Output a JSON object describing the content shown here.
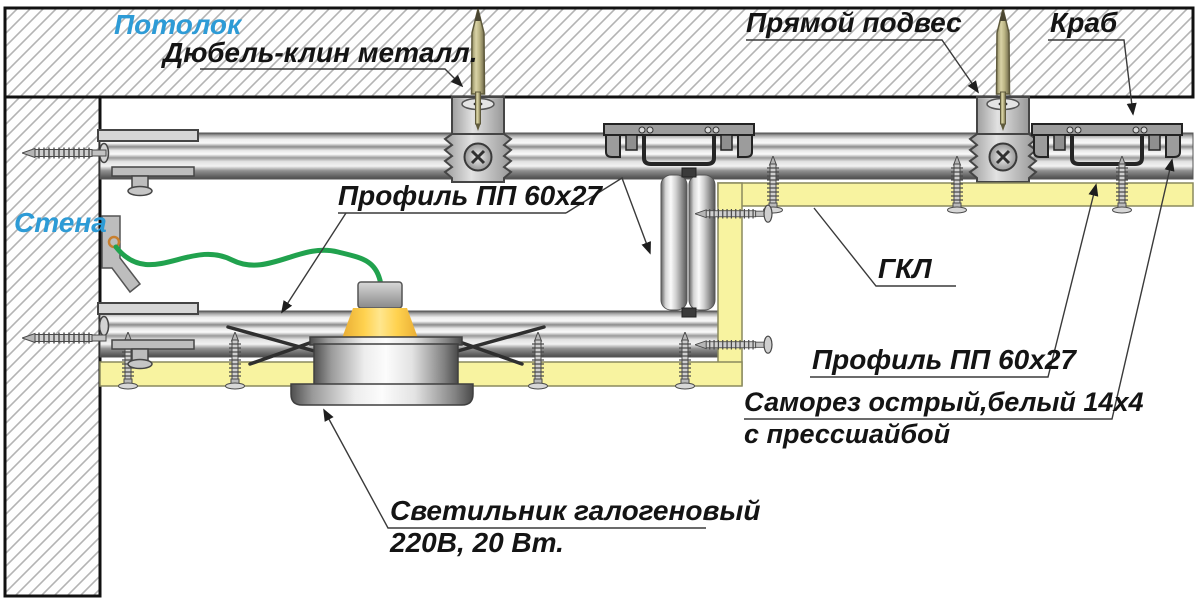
{
  "labels": {
    "ceiling": "Потолок",
    "anchor": "Дюбель-клин металл.",
    "direct_hanger": "Прямой подвес",
    "crab": "Краб",
    "wall": "Стена",
    "profile_mid": "Профиль ПП 60х27",
    "gkl": "ГКЛ",
    "profile_right": "Профиль ПП 60х27",
    "screw_line1": "Саморез острый,белый 14х4",
    "screw_line2": "с прессшайбой",
    "lamp_line1": "Светильник галогеновый",
    "lamp_line2": "220В, 20 Вт."
  },
  "colors": {
    "label_blue": "#2d9bd6",
    "label_black": "#141414",
    "board_yellow": "#f8f3a0",
    "wire_green": "#21a24e",
    "leader_gray": "#3a3a3a"
  }
}
